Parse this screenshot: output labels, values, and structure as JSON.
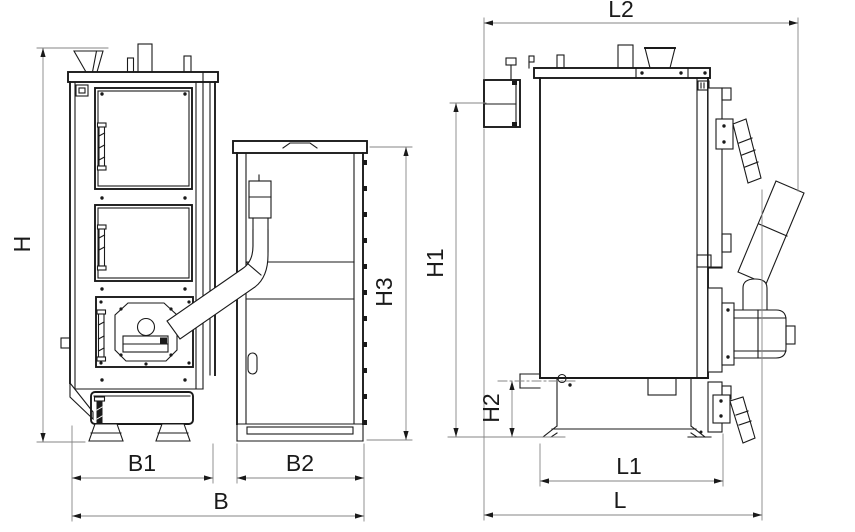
{
  "page": {
    "background": "#ffffff"
  },
  "drawing": {
    "type": "technical-dimension-drawing",
    "subject": "boiler-with-pellet-hopper-two-views",
    "line_color": "#1a1a1a",
    "dimension_line_color": "#858585",
    "dimensions": {
      "H": "H",
      "B1": "B1",
      "B2": "B2",
      "B": "B",
      "H3": "H3",
      "L2": "L2",
      "H1": "H1",
      "H2": "H2",
      "L1": "L1",
      "L": "L"
    }
  }
}
